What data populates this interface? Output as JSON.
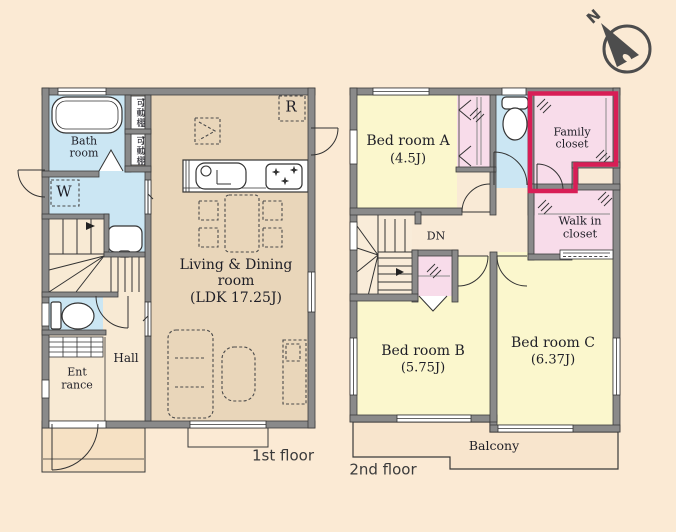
{
  "first_floor": {
    "floor_label": "1st floor",
    "bath_room": {
      "line1": "Bath",
      "line2": "room"
    },
    "movable_shelf_upper": "可動棚",
    "movable_shelf_lower": "可動棚",
    "washer_mark": "W",
    "refrigerator_mark": "R",
    "living_dining": {
      "line1": "Living & Dining",
      "line2": "room",
      "line3": "(LDK 17.25J)"
    },
    "hall": "Hall",
    "entrance": {
      "line1": "Ent",
      "line2": "rance"
    }
  },
  "second_floor": {
    "floor_label": "2nd floor",
    "bedroom_a": {
      "name": "Bed room A",
      "size": "(4.5J)"
    },
    "family_closet": {
      "line1": "Family",
      "line2": "closet"
    },
    "walk_in_closet": {
      "line1": "Walk in",
      "line2": "closet"
    },
    "stairs_down_label": "DN",
    "bedroom_b": {
      "name": "Bed room B",
      "size": "(5.75J)"
    },
    "bedroom_c": {
      "name": "Bed room C",
      "size": "(6.37J)"
    },
    "balcony": "Balcony"
  },
  "compass": {
    "north_label": "N"
  },
  "colors": {
    "background": "#fbead4",
    "ldk_floor": "#e9d6ba",
    "bedroom_floor": "#fbf7cd",
    "closet_floor": "#f8dcea",
    "water_area": "#cbe6f3",
    "entrance_floor": "#f8ead4",
    "wall": "#8a8a8a",
    "family_closet_highlight": "#d81e56"
  }
}
